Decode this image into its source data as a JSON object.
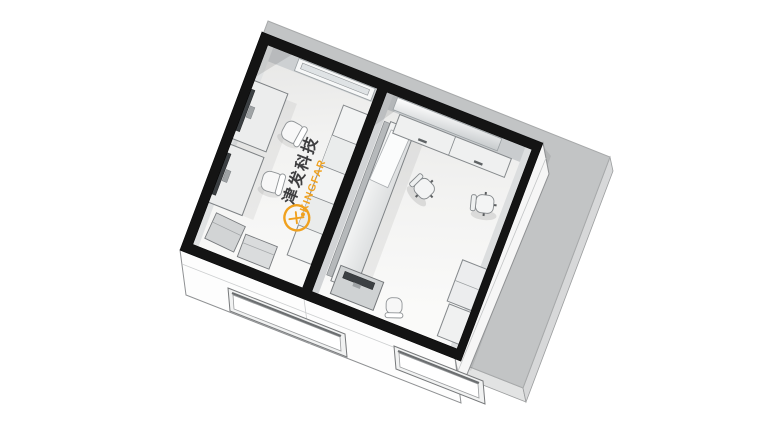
{
  "scene": {
    "description": "Isometric 3D cutaway render of a two-room lab floor plan on a gray slab",
    "background_color": "#ffffff",
    "ground_slab_color": "#c2c4c5",
    "wall_cut_color": "#141414",
    "floor_color_left": "#f3f3f2",
    "floor_color_right": "#f4f4f3",
    "exterior_wall_color": "#fbfbfb"
  },
  "logo": {
    "brand_zh": "津发科技",
    "brand_en": "KINGFAR",
    "accent_color": "#F0A11E",
    "zh_color": "#3E3E40",
    "emblem_icon": "kingfar-figure-ring-icon"
  },
  "furniture": {
    "left_room": [
      "wall-light-recess",
      "desk-with-monitor",
      "desk-with-monitor",
      "task-chair",
      "task-chair",
      "cabinet-run",
      "storage-box",
      "storage-box",
      "floor-logo"
    ],
    "right_room": [
      "wall-window-recess",
      "sideboard-cabinet",
      "sideboard-cabinet",
      "long-table",
      "leaning-board",
      "office-chair",
      "office-chair",
      "corner-desk-with-monitor",
      "visitor-chair",
      "storage-cabinet",
      "storage-cabinet"
    ],
    "exterior": [
      "window-opening",
      "window-opening"
    ]
  }
}
